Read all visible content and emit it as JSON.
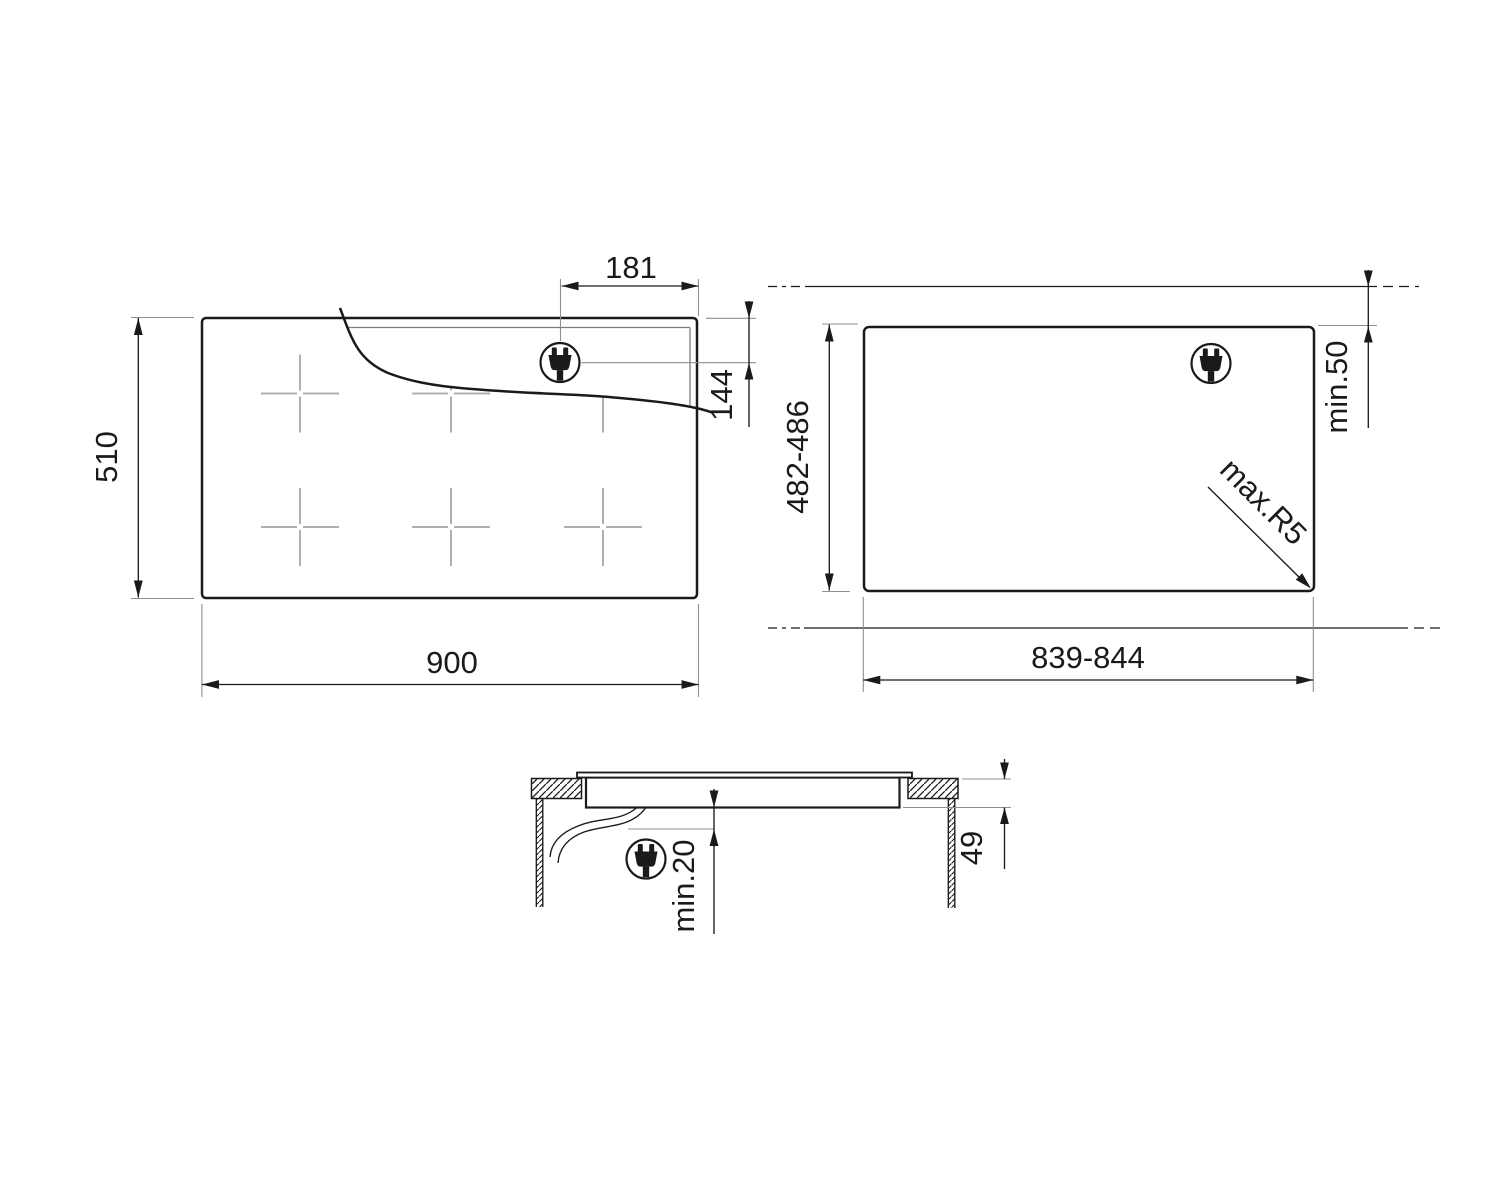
{
  "drawing": {
    "type": "appliance installation dimension drawing",
    "top_view": {
      "width_label": "900",
      "height_label": "510",
      "plug_offset_x_label": "181",
      "plug_offset_y_label": "144"
    },
    "cutout_view": {
      "width_label": "839-844",
      "height_label": "482-486",
      "rear_clearance_label": "min.50",
      "corner_radius_label": "max.R5"
    },
    "side_view": {
      "depth_label": "49",
      "bottom_clearance_label": "min.20"
    },
    "icons": {
      "power_plug": "power-plug-icon"
    },
    "colors": {
      "line": "#1a1a1a",
      "extension_line": "#8f8f8f",
      "zone_mark": "#b0b0b0",
      "background": "#ffffff"
    }
  }
}
